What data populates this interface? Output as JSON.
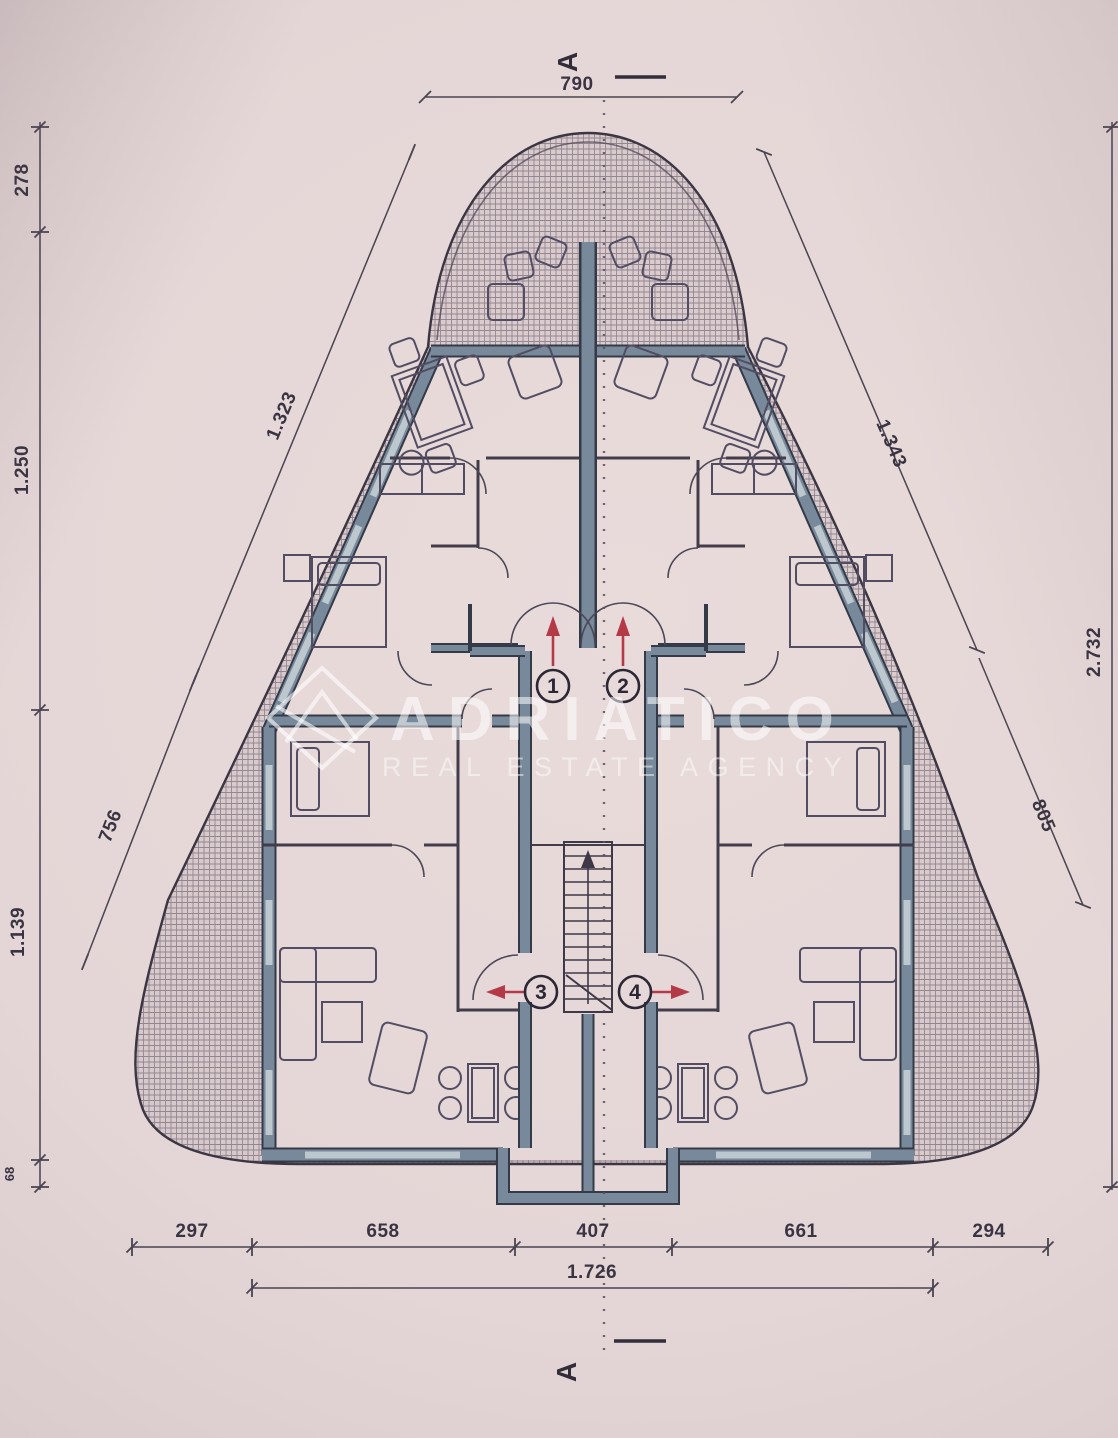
{
  "watermark": {
    "title": "ADRIATICO",
    "subtitle": "REAL ESTATE AGENCY"
  },
  "section_markers": {
    "top": "A",
    "bottom": "A"
  },
  "units": [
    {
      "number": "1"
    },
    {
      "number": "2"
    },
    {
      "number": "3"
    },
    {
      "number": "4"
    }
  ],
  "dimensions": {
    "top": "790",
    "left": {
      "v1": "278",
      "v2": "1.250",
      "v3": "1.139",
      "v4": "68",
      "d1": "1.323",
      "d2": "756"
    },
    "right": {
      "d1": "1.343",
      "d2": "805",
      "v1": "2.732"
    },
    "bottom": {
      "b1": "297",
      "b2": "658",
      "b3": "407",
      "b4": "661",
      "b5": "294",
      "total": "1.726"
    }
  },
  "colors": {
    "paper": "#e5d7d6",
    "wall_fill": "#77899a",
    "wall_edge": "#343a47",
    "window_fill": "#bcc7ce",
    "thin_line": "#433d4b",
    "hatch_line": "#5d5565",
    "dim_text": "#3a3442",
    "arrow_red": "#b43a48",
    "watermark": "rgba(255,255,255,0.55)"
  }
}
